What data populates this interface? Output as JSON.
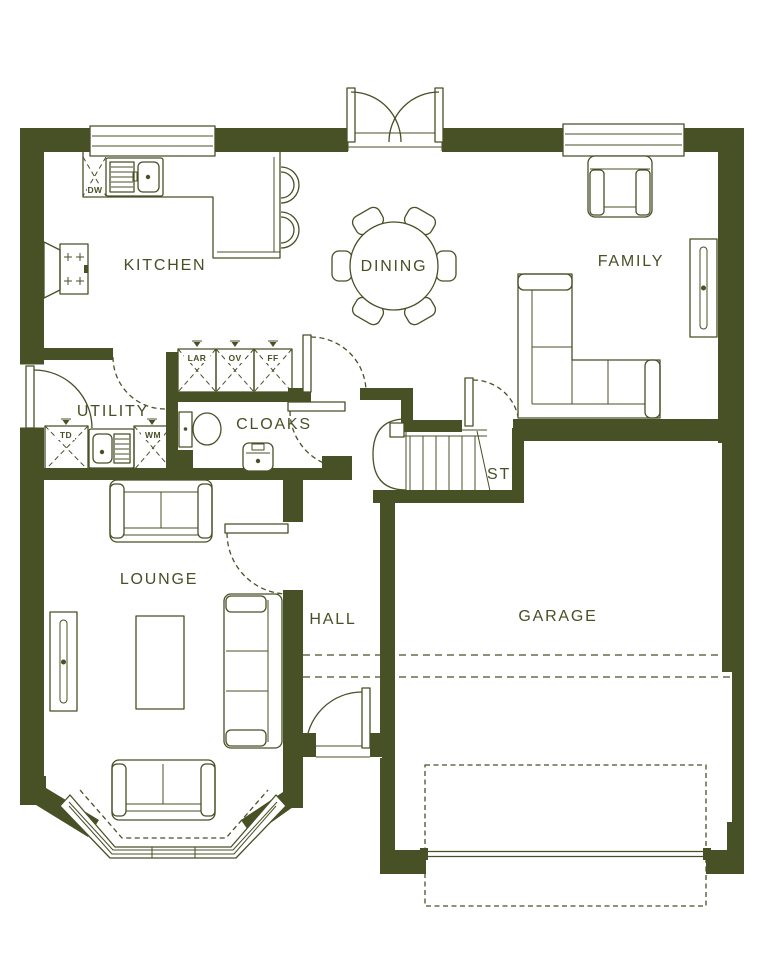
{
  "plan": {
    "rooms": {
      "kitchen": "KITCHEN",
      "dining": "DINING",
      "family": "FAMILY",
      "utility": "UTILITY",
      "cloaks": "CLOAKS",
      "stairs": "ST",
      "lounge": "LOUNGE",
      "hall": "HALL",
      "garage": "GARAGE"
    },
    "appliances": {
      "dishwasher": "DW",
      "larder": "LAR",
      "oven": "OV",
      "fridge_freezer": "FF",
      "tumble_dryer": "TD",
      "washing_machine": "WM"
    },
    "fixtures": [
      "kitchen-sink",
      "hob",
      "breakfast-bar-stools",
      "dining-table-six-chairs",
      "french-doors",
      "armchair",
      "corner-sofa",
      "radiators",
      "two-seat-sofas",
      "three-seat-sofa",
      "coffee-table",
      "utility-sink",
      "wc",
      "basin",
      "staircase",
      "bay-window",
      "front-door",
      "garage-door"
    ],
    "colors": {
      "wall": "#485026",
      "background": "#ffffff"
    }
  }
}
